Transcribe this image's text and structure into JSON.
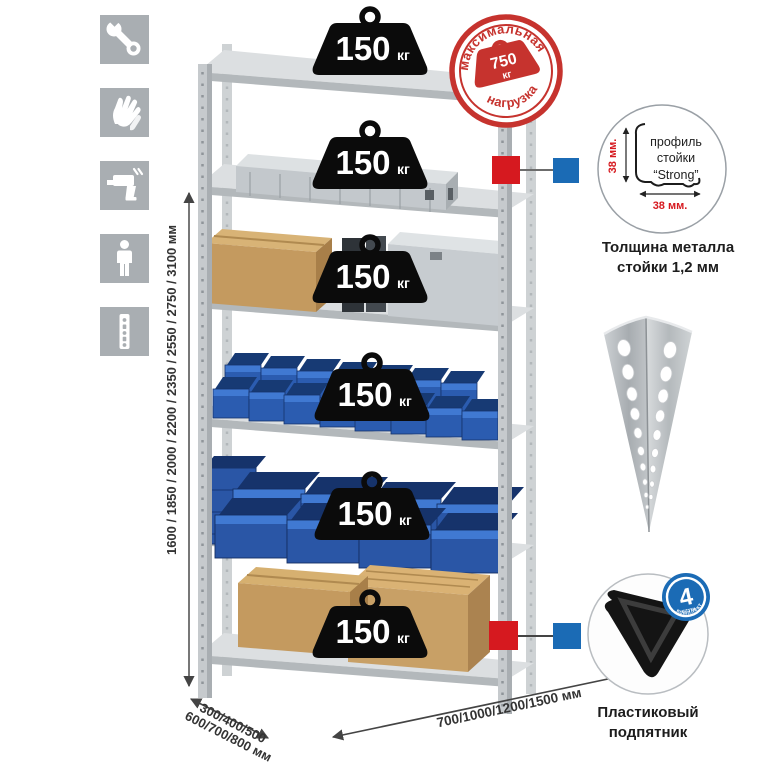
{
  "sidebar": {
    "icons": [
      {
        "name": "wrench"
      },
      {
        "name": "gloves"
      },
      {
        "name": "drill"
      },
      {
        "name": "person"
      },
      {
        "name": "rack-post"
      }
    ]
  },
  "stamp": {
    "arc_top": "максимальная",
    "arc_bottom": "нагрузка",
    "weight_value": "750",
    "weight_unit": "кг"
  },
  "weights": {
    "value": "150",
    "unit": "кг"
  },
  "dimensions": {
    "height": "1600 / 1850 / 2000 / 2200 / 2350 / 2550 / 2750 / 3100 мм",
    "depth_line1": "300/400/500",
    "depth_line2": "600/700/800 мм",
    "width": "700/1000/1200/1500 мм"
  },
  "profile_callout": {
    "line1": "профиль",
    "line2": "стойки",
    "line3": "“Strong”",
    "dim_vertical": "38 мм.",
    "dim_horizontal": "38 мм.",
    "caption_line1": "Толщина металла",
    "caption_line2": "стойки 1,2 мм"
  },
  "foot_callout": {
    "badge_value": "4",
    "badge_unit": "штуки",
    "badge_arc": "в комплекте",
    "caption_line1": "Пластиковый",
    "caption_line2": "подпятник"
  },
  "colors": {
    "stamp_red": "#c6332e",
    "marker_red": "#d6191f",
    "marker_blue": "#1b6bb5",
    "icon_gray": "#a9aeb2",
    "bin_blue": "#2b5cb0",
    "box_tan": "#c49a5f",
    "dim_red": "#d6191f"
  }
}
